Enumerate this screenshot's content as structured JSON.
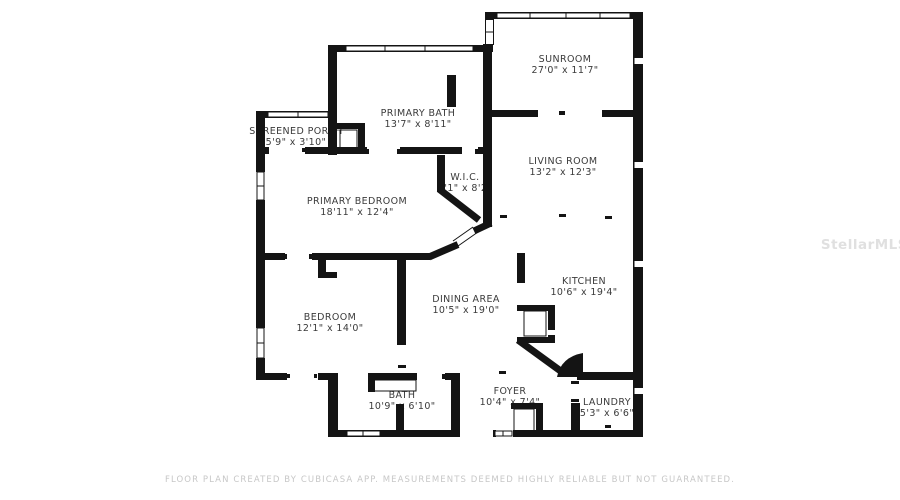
{
  "watermark": {
    "text": "StellarMLS"
  },
  "footer": {
    "disclaimer": "FLOOR PLAN CREATED BY CUBICASA APP. MEASUREMENTS DEEMED HIGHLY RELIABLE BUT NOT GUARANTEED."
  },
  "rooms": [
    {
      "name": "SUNROOM",
      "dims": "27'0\" x 11'7\""
    },
    {
      "name": "SCREENED PORCH",
      "dims": "5'9\" x 3'10\""
    },
    {
      "name": "PRIMARY BATH",
      "dims": "13'7\" x 8'11\""
    },
    {
      "name": "LIVING ROOM",
      "dims": "13'2\" x 12'3\""
    },
    {
      "name": "W.I.C.",
      "dims": "4'1\" x 8'2\""
    },
    {
      "name": "PRIMARY BEDROOM",
      "dims": "18'11\" x 12'4\""
    },
    {
      "name": "KITCHEN",
      "dims": "10'6\" x 19'4\""
    },
    {
      "name": "DINING AREA",
      "dims": "10'5\" x 19'0\""
    },
    {
      "name": "BEDROOM",
      "dims": "12'1\" x 14'0\""
    },
    {
      "name": "BATH",
      "dims": "10'9\" x 6'10\""
    },
    {
      "name": "FOYER",
      "dims": "10'4\" x 7'4\""
    },
    {
      "name": "LAUNDRY",
      "dims": "5'3\" x 6'6\""
    }
  ],
  "colors": {
    "wall": "#141414",
    "floor": "#ffffff",
    "room_label": "#3b3b3b",
    "footer_text": "#c7c7c7",
    "watermark": "#e0e0e0"
  }
}
